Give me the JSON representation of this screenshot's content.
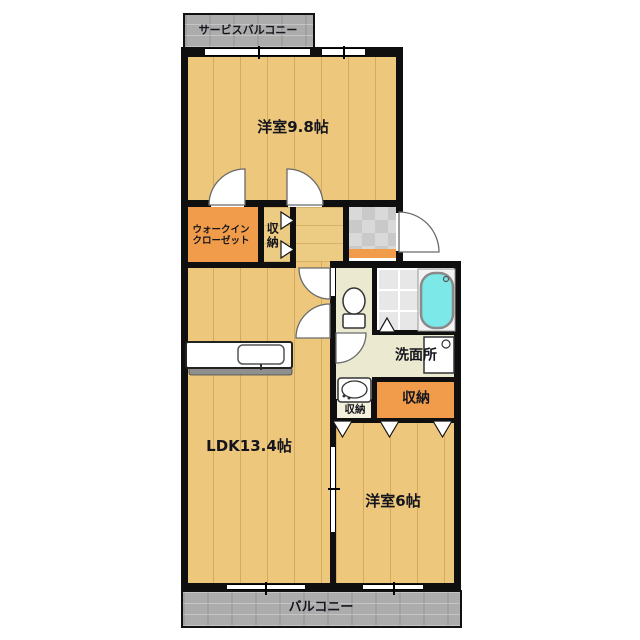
{
  "floorplan": {
    "labels": {
      "service_balcony": "サービスバルコニー",
      "bedroom_main": "洋室9.8帖",
      "wic_line1": "ウォークイン",
      "wic_line2": "クローゼット",
      "storage_upper": "収納",
      "washroom": "洗面所",
      "storage_small": "収納",
      "storage_large": "収納",
      "ldk": "LDK13.4帖",
      "bedroom_second": "洋室6帖",
      "balcony": "バルコニー"
    },
    "colors": {
      "wall": "#0f0f0f",
      "wood_floor": "#edc87c",
      "closet_orange": "#f09c4a",
      "sanitary_beige": "#ebead0",
      "entrance_tile_gray": "#d2d2d2",
      "balcony_gray": "#acacac",
      "bathtub_cyan": "#7de8e8"
    },
    "fixtures": [
      "toilet",
      "bathtub",
      "washbasin",
      "washing-machine",
      "kitchen-sink"
    ]
  }
}
